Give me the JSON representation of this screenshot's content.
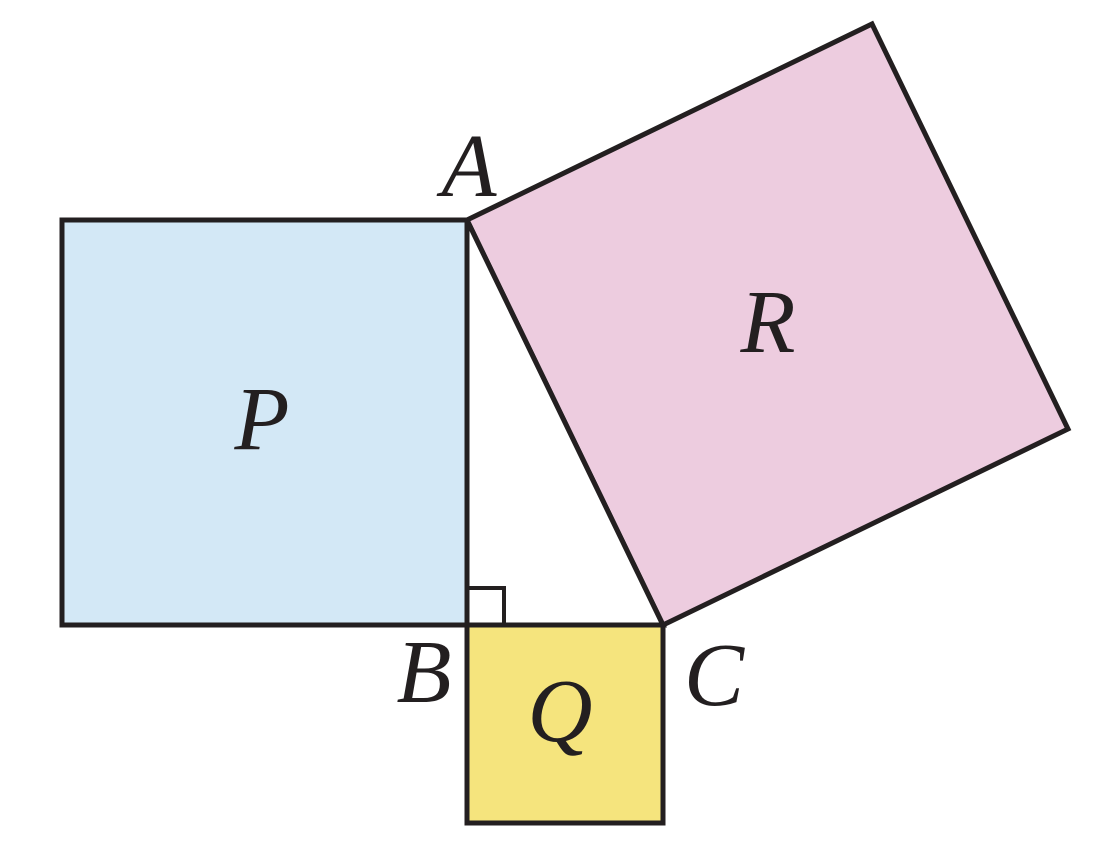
{
  "figure": {
    "title": "Right triangle ABC with squares P, Q and R drawn on its three sides (Pythagorean theorem diagram)",
    "colors": {
      "square_p_fill": "#d3e8f6",
      "square_q_fill": "#f5e47d",
      "square_r_fill": "#edccdf",
      "triangle_fill": "#ffffff",
      "stroke": "#231f20",
      "background": "#ffffff"
    },
    "stroke_width_main": "5",
    "stroke_width_marker": "4",
    "shapes": {
      "square_p": {
        "points": "62,220 467,220 467,625 62,625"
      },
      "square_q": {
        "points": "467,625 663,625 663,823 467,823"
      },
      "square_r": {
        "points": "467,220 872,24 1068,429 663,625"
      },
      "triangle_abc": {
        "points": "467,220 467,625 663,625"
      },
      "right_angle_marker": {
        "points": "467,588 504,588 504,625"
      }
    },
    "vertices": {
      "A": {
        "label": "A",
        "x": "469",
        "y": "196"
      },
      "B": {
        "label": "B",
        "x": "424",
        "y": "702"
      },
      "C": {
        "label": "C",
        "x": "714",
        "y": "705"
      }
    },
    "square_labels": {
      "P": {
        "label": "P",
        "x": "262",
        "y": "449"
      },
      "Q": {
        "label": "Q",
        "x": "560",
        "y": "741"
      },
      "R": {
        "label": "R",
        "x": "768",
        "y": "352"
      }
    }
  }
}
